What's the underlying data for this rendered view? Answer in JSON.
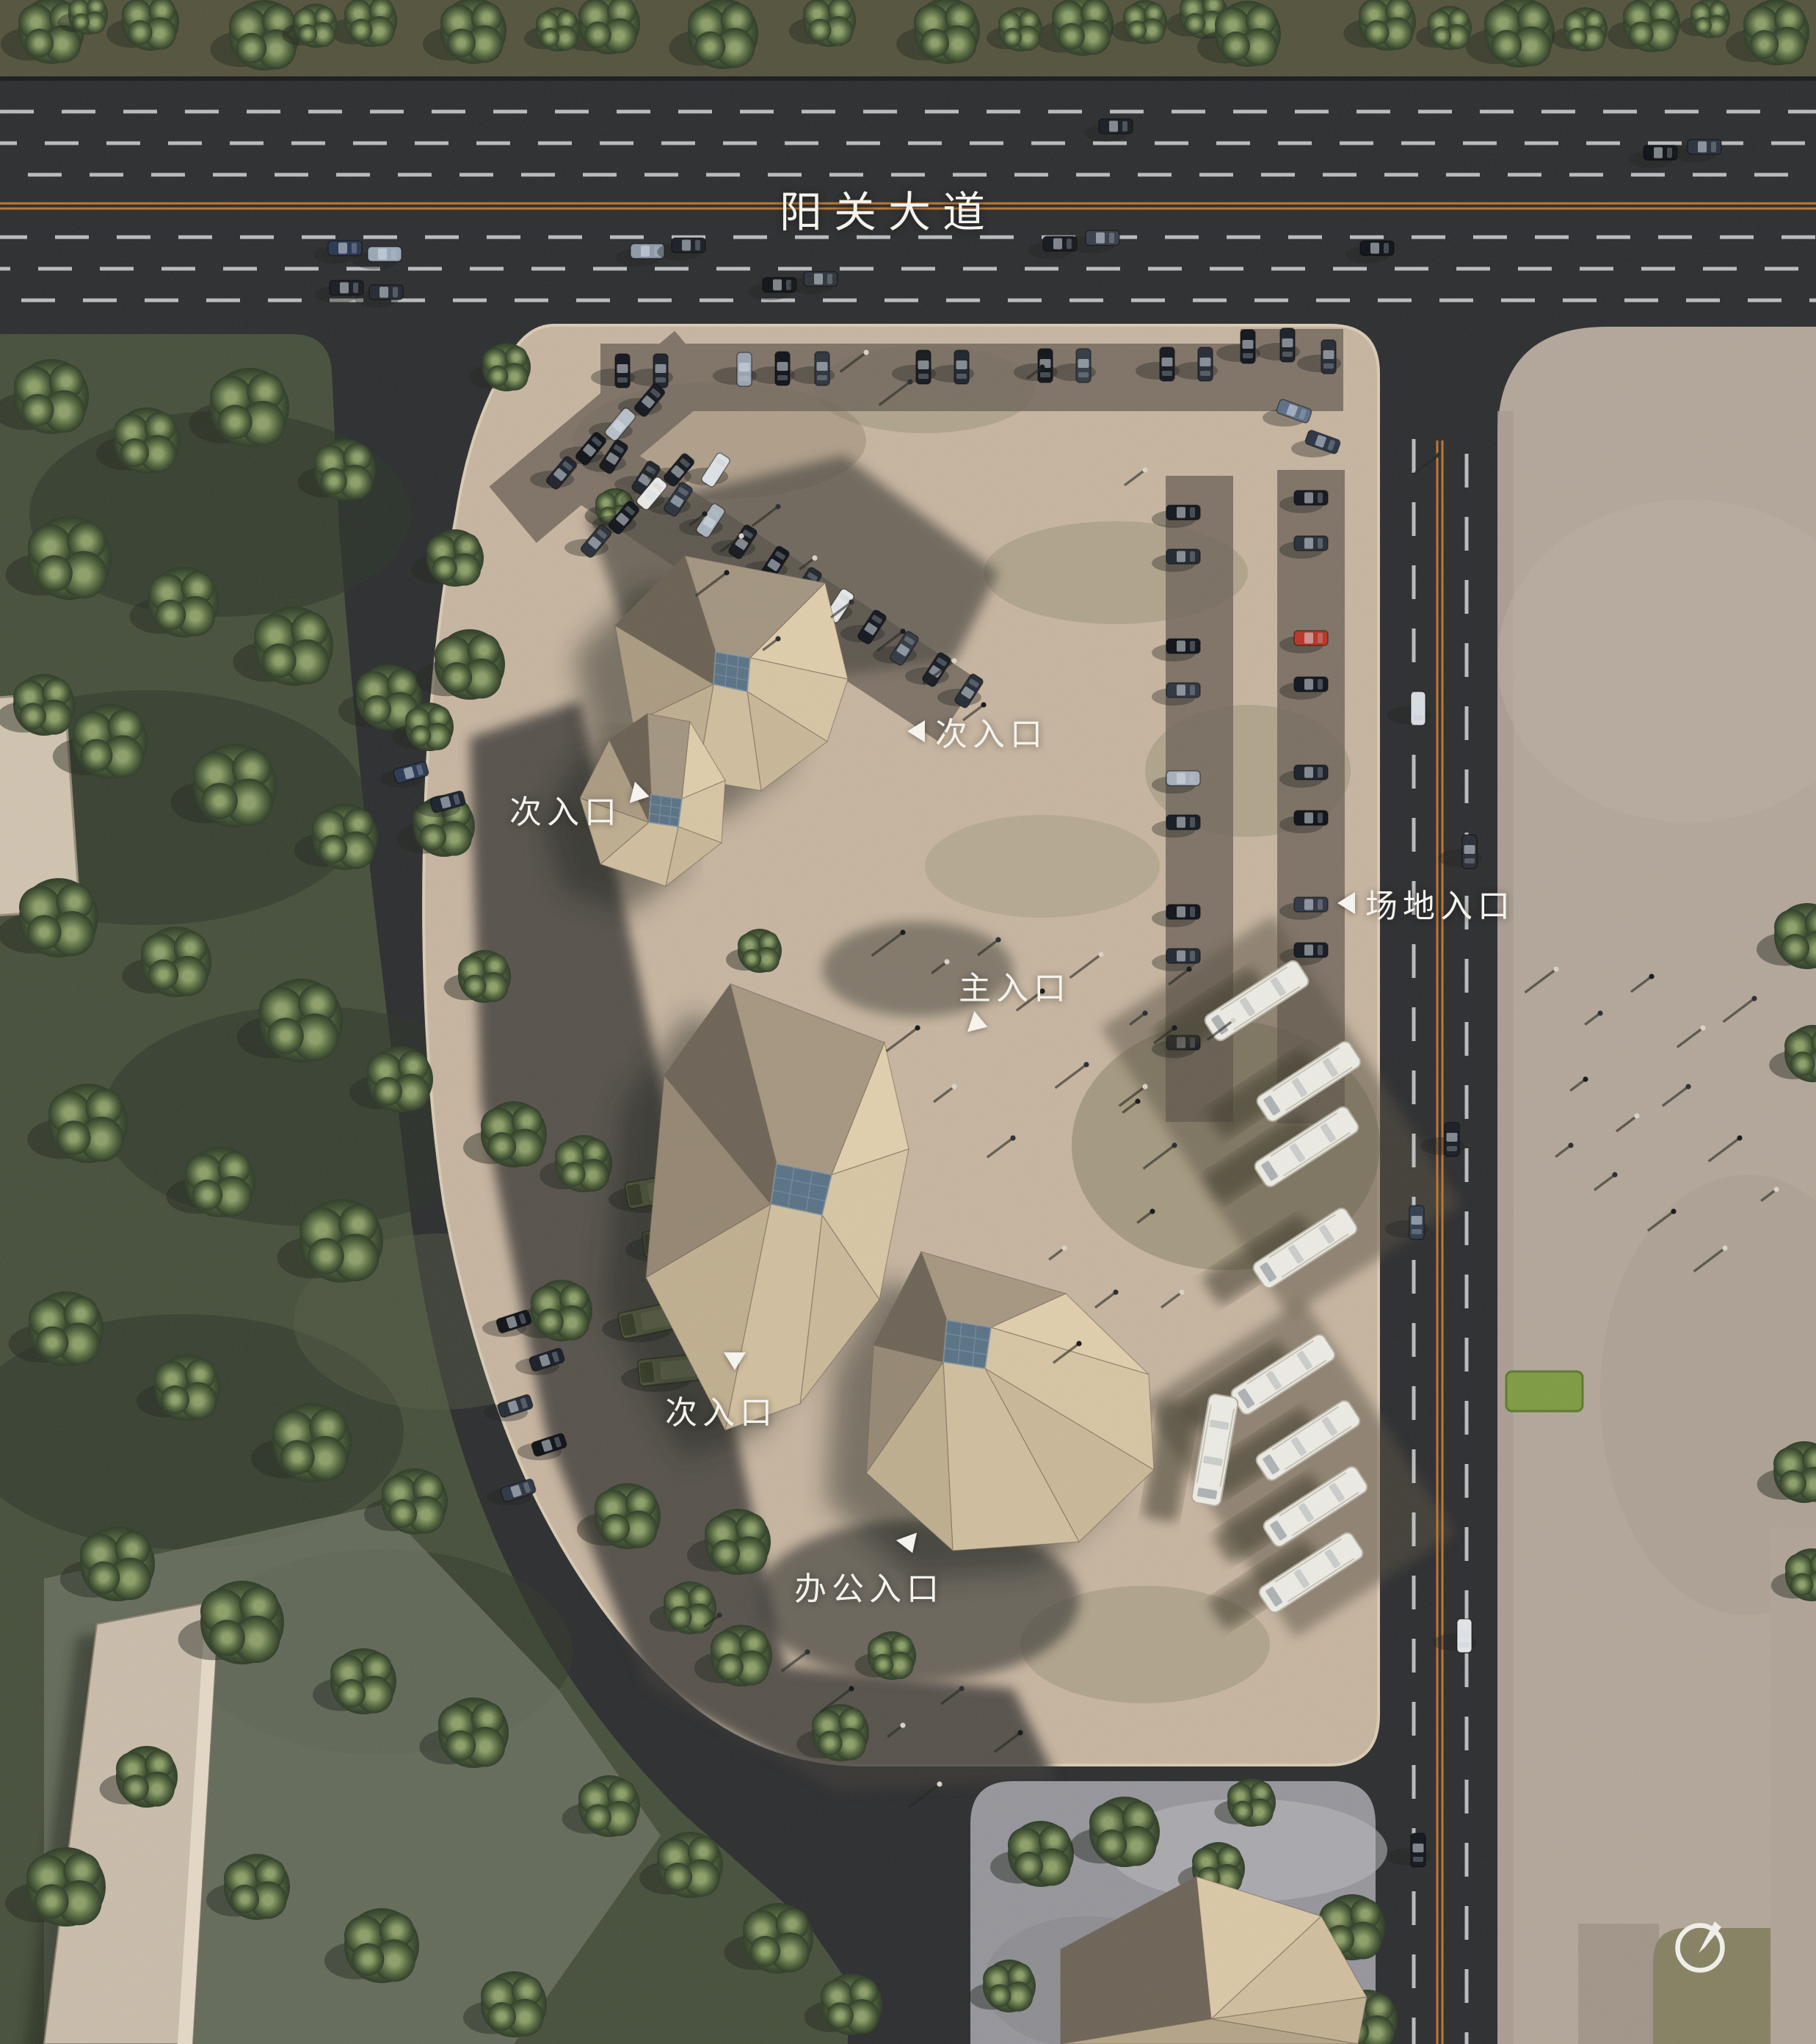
{
  "road": {
    "name": "阳关大道"
  },
  "labels": {
    "secondary_entrance_top": "次入口",
    "secondary_entrance_left": "次入口",
    "secondary_entrance_lower": "次入口",
    "main_entrance": "主入口",
    "site_entrance": "场地入口",
    "office_entrance": "办公入口"
  },
  "compass": {
    "icon": "compass-needle-icon"
  },
  "colors": {
    "asphalt": "#2e2f31",
    "lane_marking": "#cbccce",
    "center_line_orange": "#c0762e",
    "site_paving": "#c7b5a0",
    "parking_strip": "#6e655a",
    "roof_light": "#dfcdab",
    "roof_dark": "#6b6254",
    "skylight_glass": "#5a7386",
    "lawn": "#47513c",
    "tree_green": "#55683f",
    "right_parcel": "#b3a79a",
    "bottom_parcel_pavers": "#96969c",
    "label_text": "#f4f3ee"
  }
}
